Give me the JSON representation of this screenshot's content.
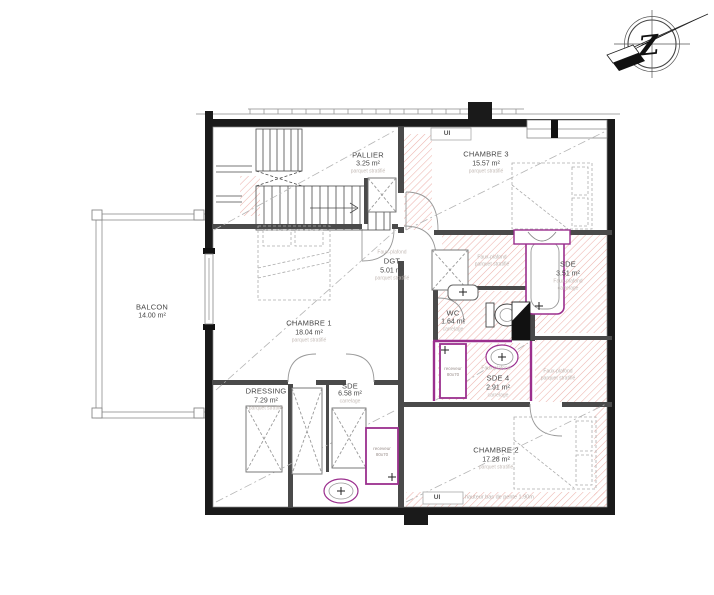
{
  "rooms": {
    "pallier": {
      "name": "PALLIER",
      "area": "3.25 m²",
      "material": "parquet stratifié"
    },
    "chambre3": {
      "name": "CHAMBRE 3",
      "area": "15.57 m²",
      "material": "parquet stratifié"
    },
    "balcon": {
      "name": "BALCON",
      "area": "14.00 m²"
    },
    "chambre1": {
      "name": "CHAMBRE 1",
      "area": "18.04 m²",
      "material": "parquet stratifié"
    },
    "dgt": {
      "ceiling": "Faux-plafond",
      "name": "DGT",
      "area": "5.01 m²",
      "material": "parquet stratifié"
    },
    "sde_bain": {
      "name": "SDE",
      "area": "3.51 m²",
      "ceiling": "Faux-plafond",
      "material": "carrelage"
    },
    "wc": {
      "name": "WC",
      "area": "1.64 m²",
      "material": "carrelage"
    },
    "sde4": {
      "ceiling": "Faux-plafond",
      "name": "SDE 4",
      "area": "2.91 m²",
      "material": "carrelage"
    },
    "dressing": {
      "name": "DRESSING",
      "area": "7.29 m²",
      "material": "parquet stratifié"
    },
    "sde_bas": {
      "name": "SDE",
      "area": "6.58 m²",
      "material": "carrelage"
    },
    "chambre2": {
      "name": "CHAMBRE 2",
      "area": "17.28 m²",
      "material": "parquet stratifié"
    }
  },
  "zones": {
    "fp_corridor": {
      "line1": "Faux-plafond",
      "line2": "parquet stratifié"
    },
    "fp_right": {
      "line1": "Faux-plafond",
      "line2": "parquet stratifié"
    }
  },
  "annotations": {
    "ui_top": "UI",
    "ui_bottom": "UI",
    "pente": "hauteur bas de pente 1.90m",
    "receveur1": {
      "line1": "receveur",
      "line2": "80x70"
    },
    "receveur2": {
      "line1": "receveur",
      "line2": "80x70"
    }
  },
  "compass": {
    "letter": "Z"
  },
  "colors": {
    "wall": "#1a1a1a",
    "interior_wall": "#4a4a4a",
    "fixture": "#9b2f8e",
    "hatch": "#ecb3ad"
  }
}
